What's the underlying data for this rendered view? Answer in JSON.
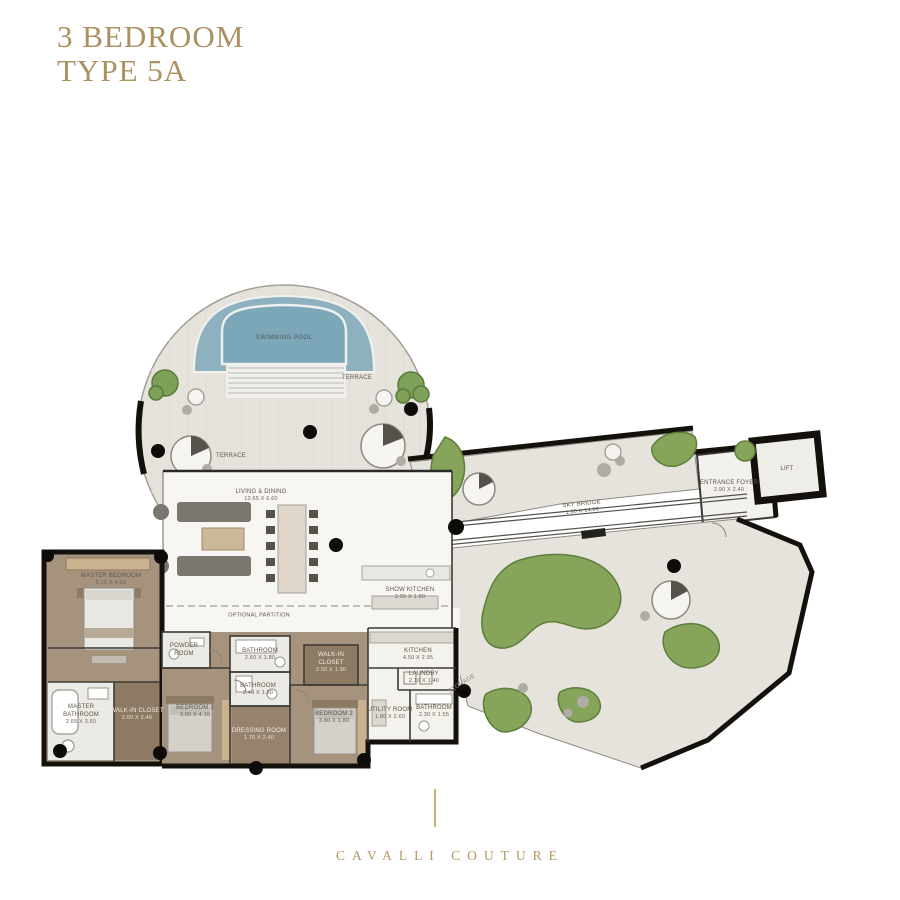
{
  "title": {
    "line1": "3 BEDROOM",
    "line2": "TYPE 5A"
  },
  "footer": {
    "brand": "CAVALLI COUTURE"
  },
  "colors": {
    "gold": "#ab9160",
    "wall_black": "#14110d",
    "terrace_floor": "#e6e3dd",
    "interior_floor": "#f7f6f2",
    "suite_brown": "#a6937e",
    "closet_brown": "#8d7a64",
    "pool_outer_blue": "#8eb1c0",
    "pool_inner_blue": "#7ca7b8",
    "garden_green": "#86a55b",
    "garden_green_dark": "#5d7d3b"
  },
  "labels": {
    "swimming_pool": "SWIMMING POOL",
    "terrace_upper": "TERRACE",
    "terrace_left": "TERRACE",
    "living_dining": {
      "name": "LIVING & DINING",
      "dims": "13.65 X 6.60"
    },
    "optional_partition": "OPTIONAL PARTITION",
    "sky_bridge": {
      "name": "SKY BRIDGE",
      "dims": "1.80 X 14.00"
    },
    "entrance_foyer": {
      "name": "ENTRANCE FOYER",
      "dims": "2.90 X 2.40"
    },
    "lift": "LIFT",
    "show_kitchen": {
      "name": "SHOW KITCHEN",
      "dims": "2.95 X 1.80"
    },
    "master_bedroom": {
      "name": "MASTER BEDROOM",
      "dims": "5.10 X 4.00"
    },
    "powder_room": {
      "name1": "POWDER",
      "name2": "ROOM"
    },
    "bathroom_a": {
      "name": "BATHROOM",
      "dims": "2.60 X 1.80"
    },
    "bathroom_b": {
      "name": "BATHROOM",
      "dims": "2.40 X 1.80"
    },
    "walk_in_closet_2": {
      "name1": "WALK-IN",
      "name2": "CLOSET",
      "dims": "2.50 X 1.90"
    },
    "kitchen": {
      "name": "KITCHEN",
      "dims": "4.50 X 2.95"
    },
    "laundry": {
      "name": "LAUNDRY",
      "dims": "2.10 X 1.40"
    },
    "storage": "STORAGE",
    "utility_room": {
      "name": "UTILITY ROOM",
      "dims": "1.80 X 2.60"
    },
    "bathroom_c": {
      "name": "BATHROOM",
      "dims": "2.30 X 1.55"
    },
    "bedroom_1": {
      "name": "BEDROOM 1",
      "dims": "3.80 X 4.10"
    },
    "bedroom_2": {
      "name": "BEDROOM 2",
      "dims": "3.80 X 3.80"
    },
    "dressing_room": {
      "name": "DRESSING ROOM",
      "dims": "1.70 X 2.40"
    },
    "master_bathroom": {
      "name1": "MASTER",
      "name2": "BATHROOM",
      "dims": "2.65 X 3.60"
    },
    "walk_in_closet_master": {
      "name": "WALK-IN CLOSET",
      "dims": "2.60 X 2.40"
    }
  }
}
